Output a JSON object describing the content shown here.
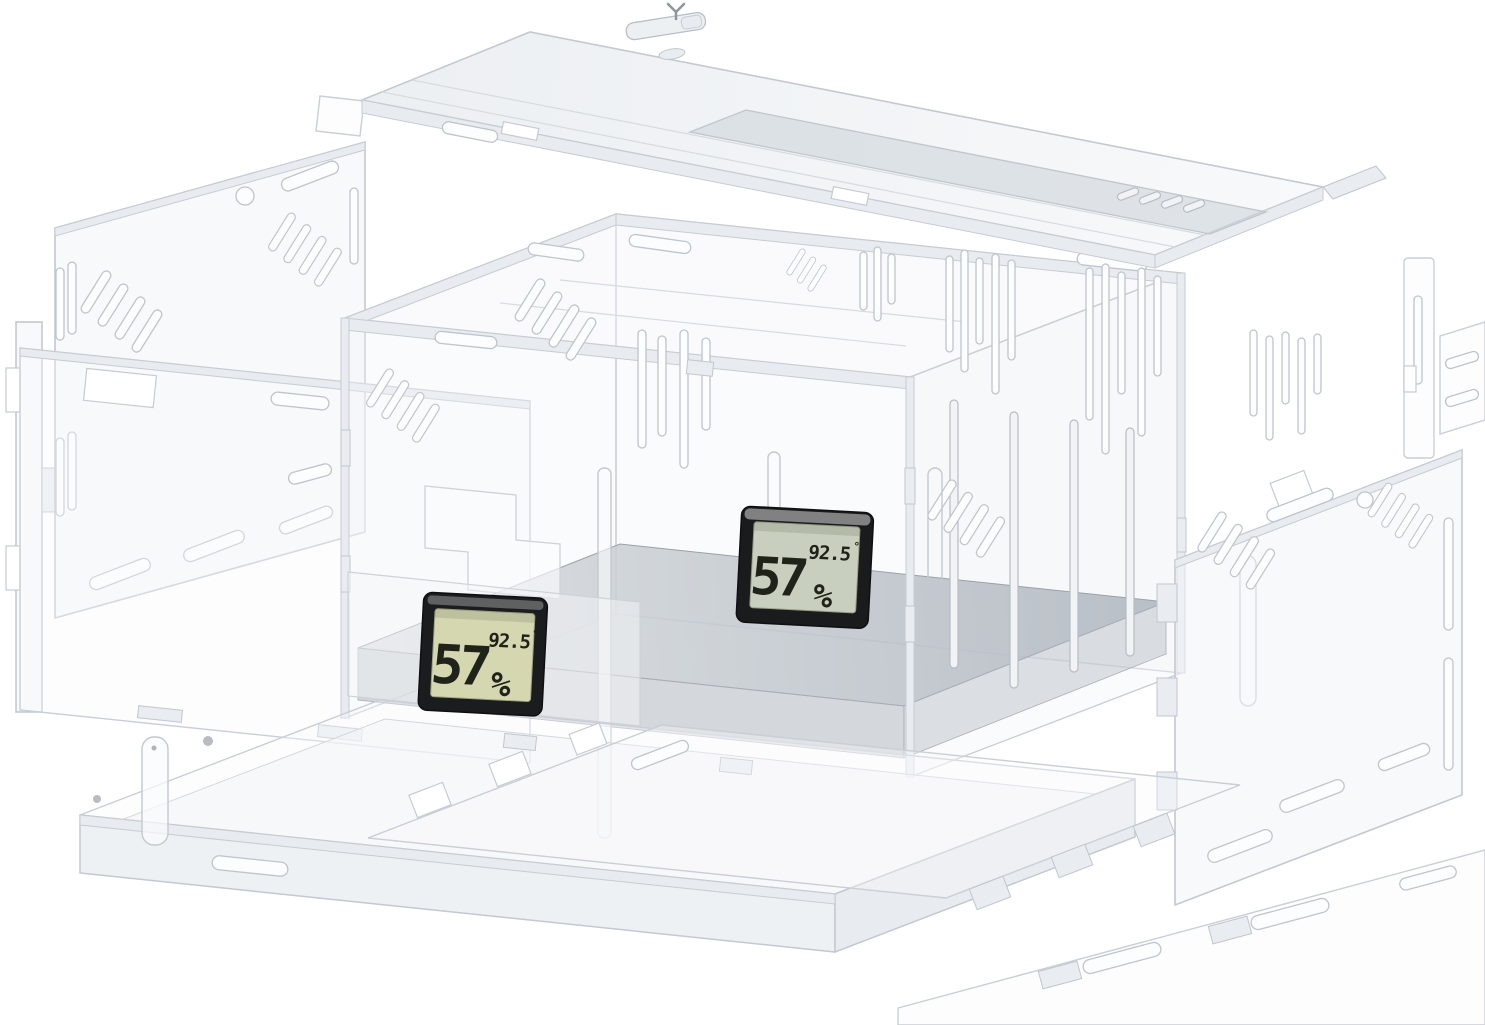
{
  "description": "Exploded view render of a clear acrylic enclosure kit with vent slots and two digital hygrometer displays",
  "background_color": "#ffffff",
  "colors": {
    "acrylic_edge": "#c2c9d0",
    "acrylic_fill": "#f2f4f6",
    "acrylic_shade": "#e7ebef",
    "floor_dark": "#aeb5bd",
    "floor_light": "#d9dce0",
    "lid_overlay_gray": "#cbd1d8",
    "hygrometer_bezel": "#1b1c1e",
    "lcd_screen_left": "#d5d7b0",
    "lcd_screen_right": "#c9cfbe",
    "lcd_digit": "#20231a"
  },
  "hygrometers": {
    "left": {
      "humidity_value": "57",
      "humidity_unit": "%",
      "temperature_value": "92.5",
      "degree_mark": "°"
    },
    "right": {
      "humidity_value": "57",
      "humidity_unit": "%",
      "temperature_value": "92.5",
      "degree_mark": "°"
    }
  }
}
